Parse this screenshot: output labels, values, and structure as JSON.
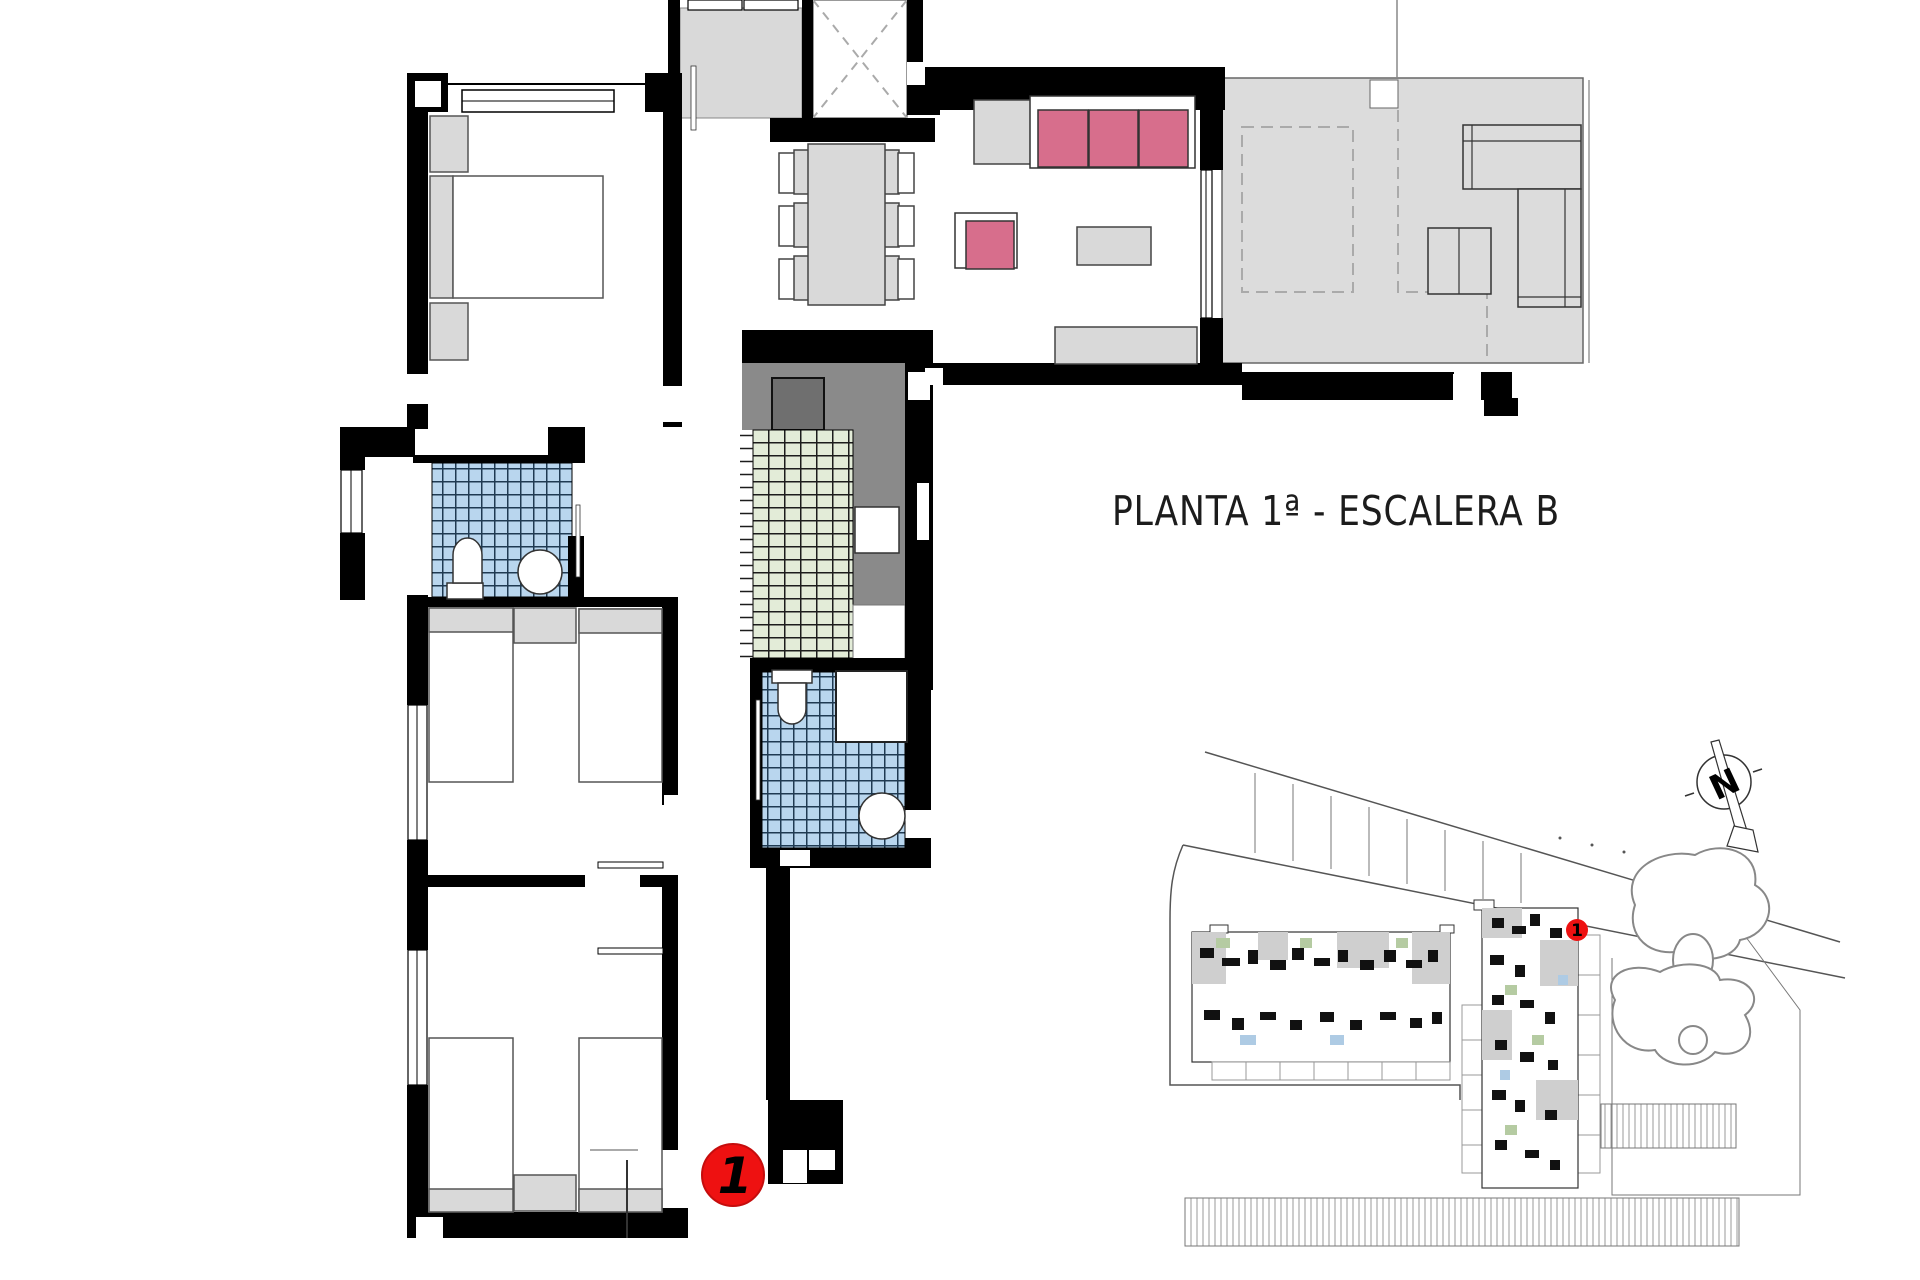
{
  "title": "PLANTA 1ª - ESCALERA B",
  "unit_marker": {
    "label": "1",
    "color": "#ee1111"
  },
  "site_plan": {
    "marker_label": "1",
    "north_label": "N"
  },
  "colors": {
    "wall_black": "#000000",
    "sofa_pink": "#d76e8c",
    "tile_blue": "#b9d6ee",
    "tile_green": "#e3ecd8",
    "furniture_gray": "#d9d9d9",
    "counter_gray": "#8a8a8a",
    "terrace_gray": "#dcdcdc",
    "marker_red": "#ee1111"
  }
}
